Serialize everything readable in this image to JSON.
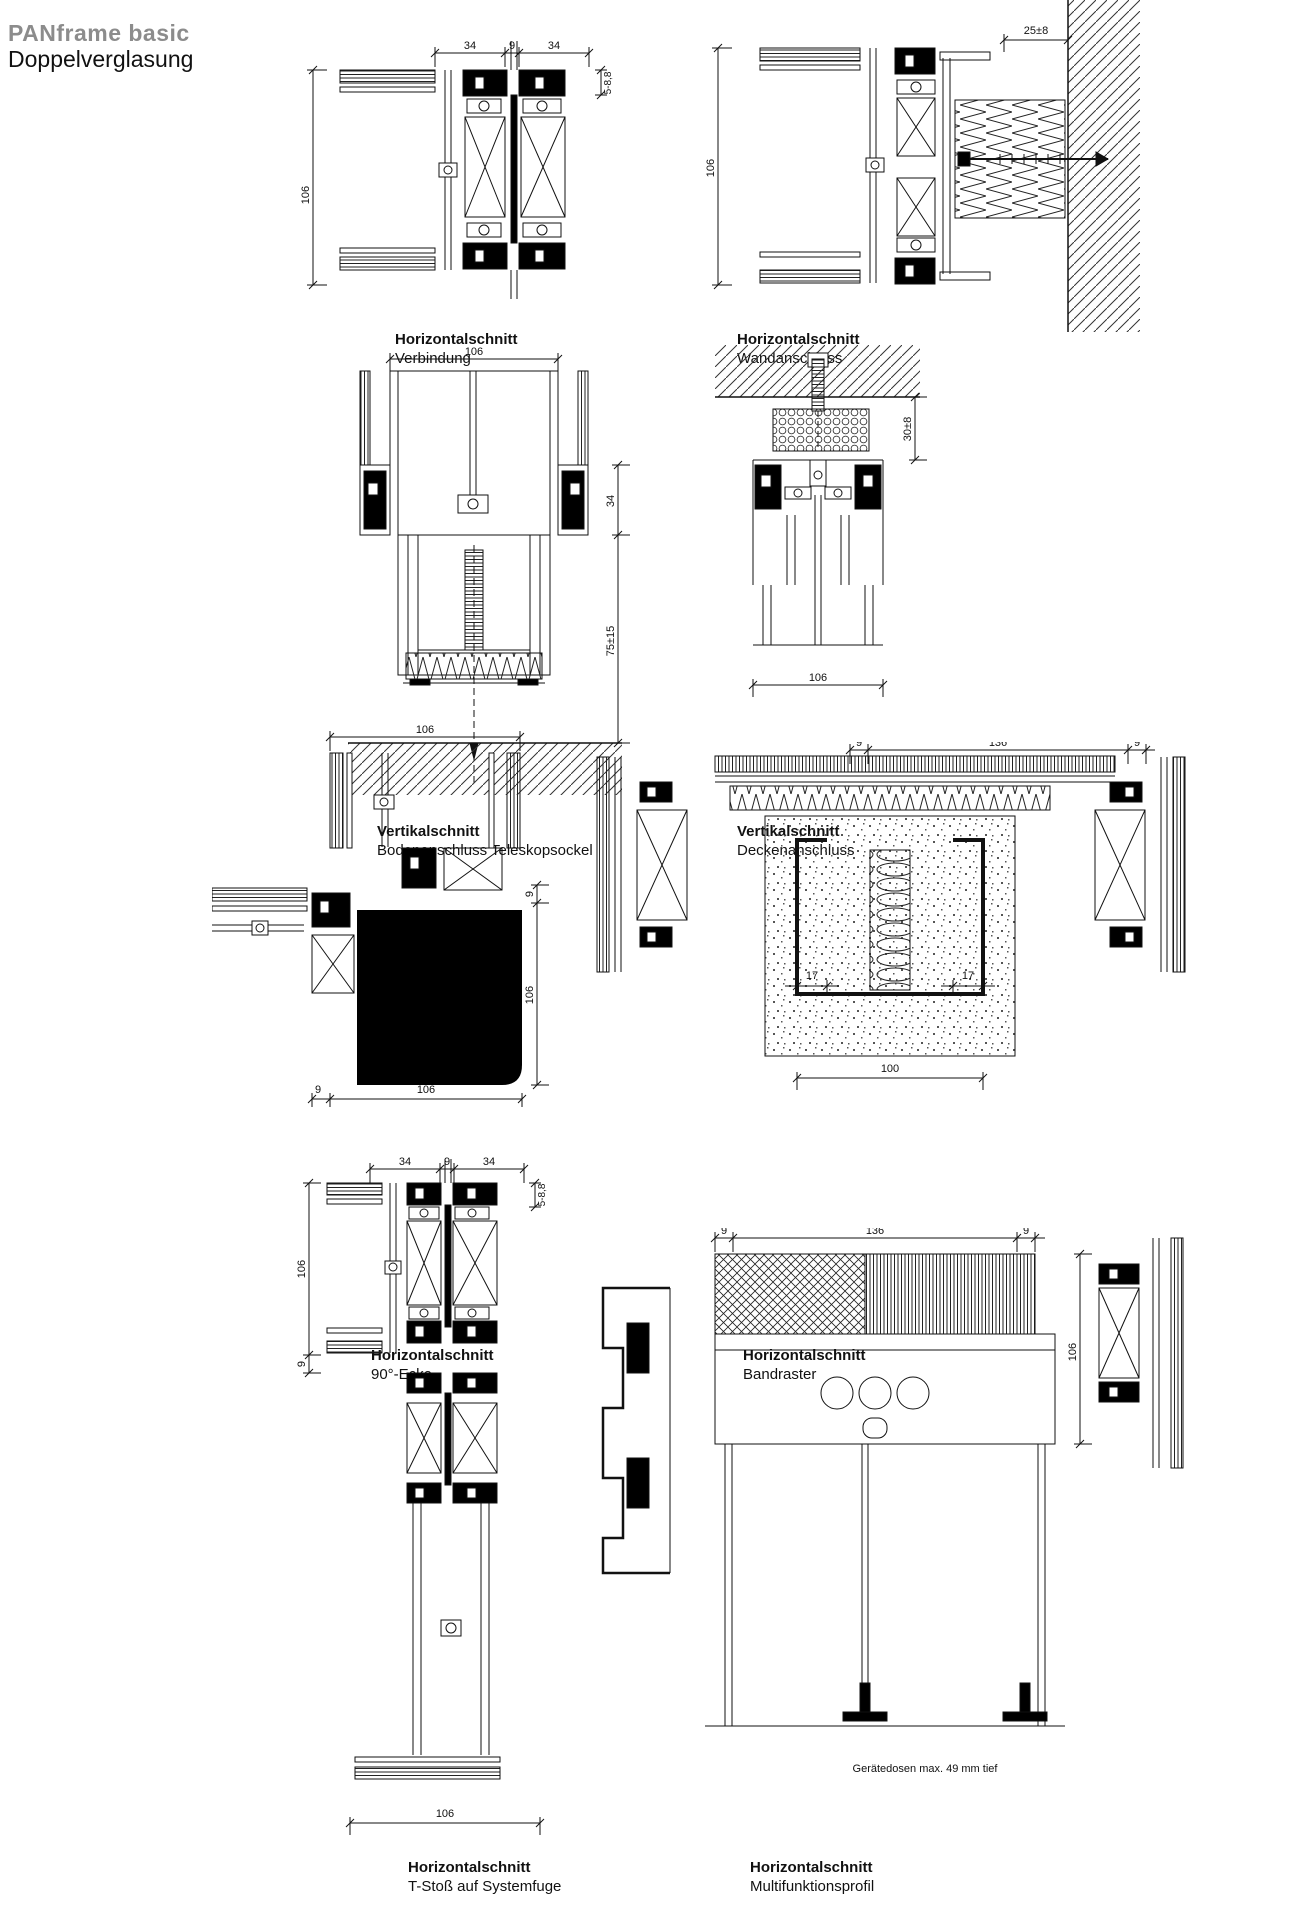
{
  "page": {
    "title_brand": "PANframe basic",
    "title_sub": "Doppelverglasung"
  },
  "colors": {
    "brand_gray": "#8c8c8c",
    "ink": "#111111"
  },
  "drawings": [
    {
      "title": "Horizontalschnitt",
      "subtitle": "Verbindung",
      "dims": {
        "top_left": "34",
        "top_mid": "9",
        "top_right": "34",
        "left": "106",
        "right": "5-8,8"
      }
    },
    {
      "title": "Horizontalschnitt",
      "subtitle": "Wandanschluss",
      "dims": {
        "left": "106",
        "top": "25±8"
      }
    },
    {
      "title": "Vertikalschnitt",
      "subtitle": "Bodenanschluss Teleskopsockel",
      "dims": {
        "top": "106",
        "right_upper": "34",
        "right_lower": "75±15"
      }
    },
    {
      "title": "Vertikalschnitt",
      "subtitle": "Deckenanschluss",
      "dims": {
        "right": "30±8",
        "bottom": "106"
      }
    },
    {
      "title": "Horizontalschnitt",
      "subtitle": "90°-Ecke",
      "dims": {
        "top": "106",
        "right_upper": "9",
        "right_lower": "106",
        "bottom_left": "9",
        "bottom_right": "106"
      }
    },
    {
      "title": "Horizontalschnitt",
      "subtitle": "Bandraster",
      "dims": {
        "top_left": "9",
        "top_mid": "136",
        "top_right": "9",
        "mid_left": "17",
        "mid_right": "17",
        "bottom": "100"
      }
    },
    {
      "title": "Horizontalschnitt",
      "subtitle": "T-Stoß auf Systemfuge",
      "dims": {
        "top_left": "34",
        "top_mid": "9",
        "top_right": "34",
        "left": "106",
        "left_lower": "9",
        "right": "5-8,8",
        "bottom": "106"
      }
    },
    {
      "title": "Horizontalschnitt",
      "subtitle": "Multifunktionsprofil",
      "dims": {
        "top_left": "9",
        "top_mid": "136",
        "top_right": "9",
        "right": "106"
      },
      "note": "Gerätedosen max. 49 mm tief"
    }
  ]
}
